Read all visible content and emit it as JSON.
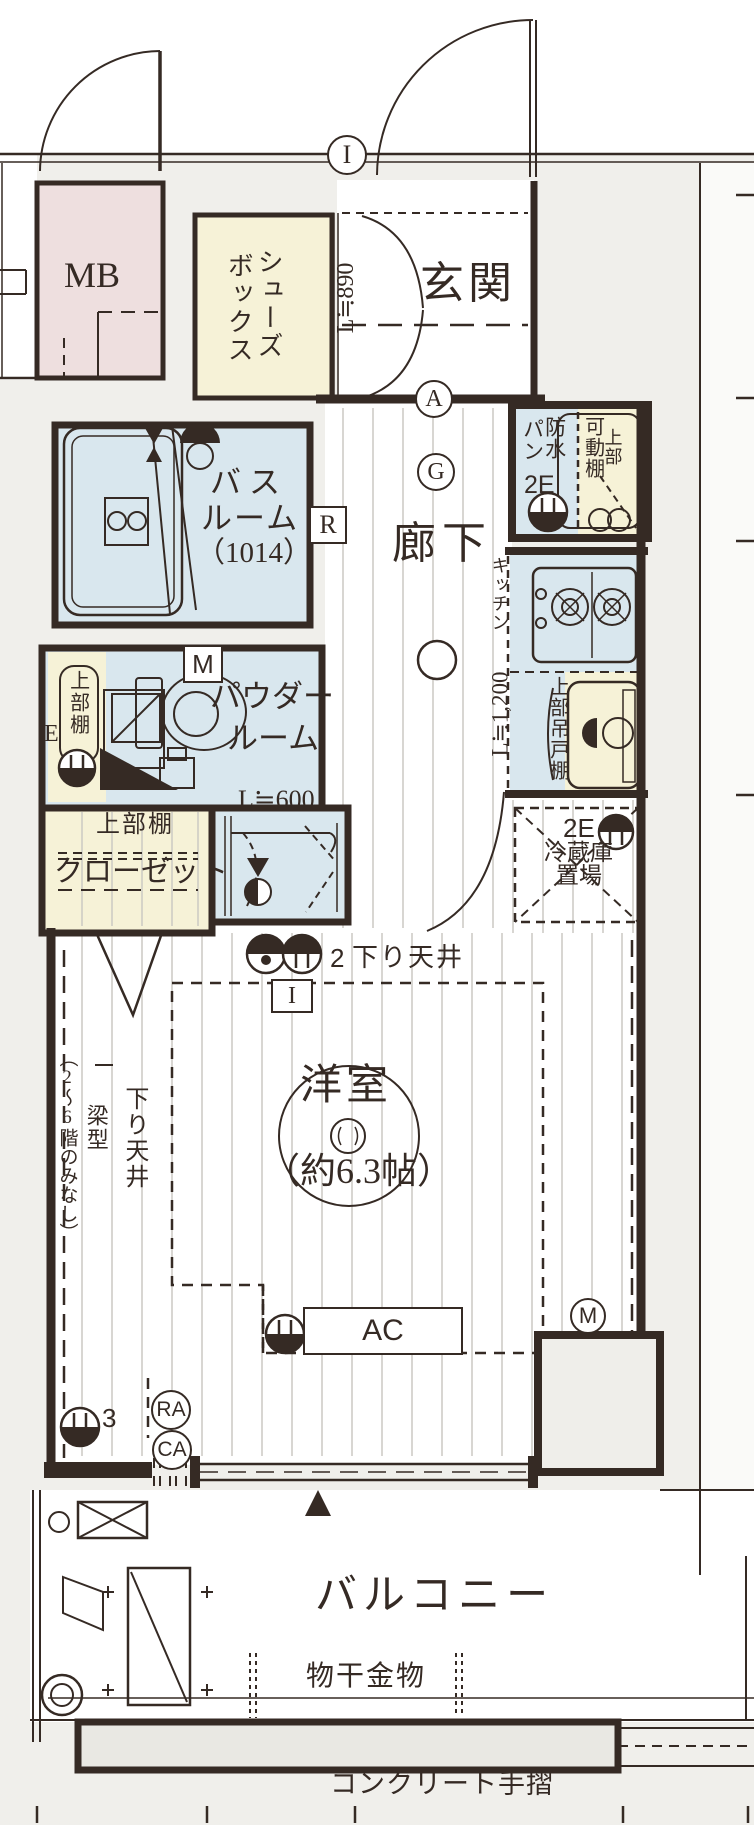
{
  "plan": {
    "rooms": {
      "meter_box": "MB",
      "shoe_box_col_right": "シューズ",
      "shoe_box_col_left": "ボックス",
      "entrance": "玄関",
      "hallway": "廊下",
      "bathroom_line1": "バス",
      "bathroom_line2": "ルーム",
      "bathroom_line3": "（1014）",
      "powder_line1": "パウダー",
      "powder_line2": "ルーム",
      "closet": "クローゼット",
      "kitchen": "キッチン",
      "western_room": "洋室",
      "western_room_size": "（約6.3帖）",
      "fridge_line1": "冷蔵庫",
      "fridge_line2": "置場",
      "balcony": "バルコニー"
    },
    "fixtures": {
      "laundry_pan_col_right": "防水",
      "laundry_pan_col_left": "パン",
      "laundry_pan_spec": "2E",
      "movable_shelf": "可動棚",
      "movable_shelf_upper": "上部",
      "hanging_cupboard": "上部吊戸棚",
      "powder_upper_shelf": "上部棚",
      "closet_upper_shelf": "上部棚",
      "fridge_spec": "2E",
      "laundry_hardware": "物干金物",
      "concrete_handrail": "コンクリート手摺",
      "air_conditioner": "AC"
    },
    "dimensions": {
      "entrance_width": "L≒890",
      "kitchen_width": "L≒1,200",
      "vanity_width": "L≒600"
    },
    "ceiling": {
      "lowered_horizontal": "下り天井",
      "lowered_vertical": "下り天井",
      "outlet_count": "2",
      "outlet_count_3": "3",
      "beam": "梁型",
      "beam_note": "（2～6階のみなし）"
    },
    "marks": {
      "i_circle": "I",
      "a_circle": "A",
      "g_circle": "G",
      "m_circle": "M",
      "r_box": "R",
      "m_box": "M",
      "i_box": "I",
      "ra_circle": "RA",
      "ca_circle": "CA",
      "e_label": "E"
    }
  }
}
